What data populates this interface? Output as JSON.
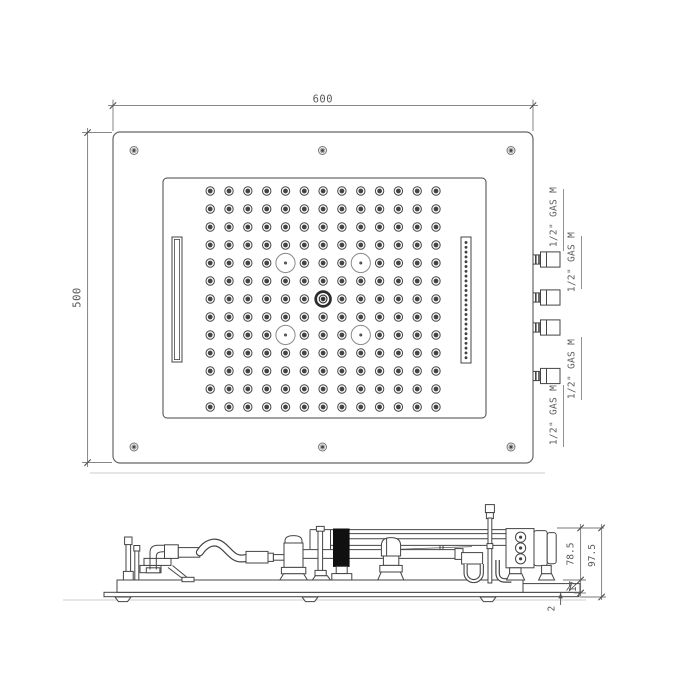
{
  "drawing": {
    "type": "shower-head-technical-drawing",
    "views": {
      "top": {
        "dim_width": "600",
        "dim_height": "500",
        "connections": [
          {
            "label": "1/2\" GAS M"
          },
          {
            "label": "1/2\" GAS M"
          },
          {
            "label": "1/2\" GAS M"
          },
          {
            "label": "1/2\" GAS M"
          }
        ],
        "stub_y": [
          259.5,
          297.5,
          327.5,
          376
        ],
        "screws": [
          [
            134,
            150.5
          ],
          [
            322.5,
            150.5
          ],
          [
            511,
            150.5
          ],
          [
            134,
            447
          ],
          [
            322.5,
            447
          ],
          [
            511,
            447
          ]
        ],
        "nozzle_grid": {
          "cols": 13,
          "rows": 13,
          "x0": 210.2,
          "y0": 191,
          "dx": 18.82,
          "dy": 18.0,
          "skip": [
            [
              4,
              4
            ],
            [
              8,
              4
            ],
            [
              4,
              8
            ],
            [
              8,
              8
            ],
            [
              6,
              6
            ]
          ]
        },
        "spotlights": [
          [
            4,
            4
          ],
          [
            8,
            4
          ],
          [
            4,
            8
          ],
          [
            8,
            8
          ]
        ],
        "knob": [
          6,
          6
        ],
        "slot_dots": {
          "x": 466,
          "y0": 242.5,
          "dy": 4.8,
          "count": 25
        }
      },
      "side": {
        "dims": {
          "assembly_height": "78.5",
          "total_height": "97.5",
          "frame_thickness": "17",
          "panel_thickness": "2"
        }
      }
    },
    "colors": {
      "line": "#444444",
      "light": "#8a8a8a",
      "dim": "#777777",
      "text": "#5a5a5a",
      "ghost": "#d8d8d8",
      "black_fill": "#101010",
      "screw": "#777777"
    }
  }
}
